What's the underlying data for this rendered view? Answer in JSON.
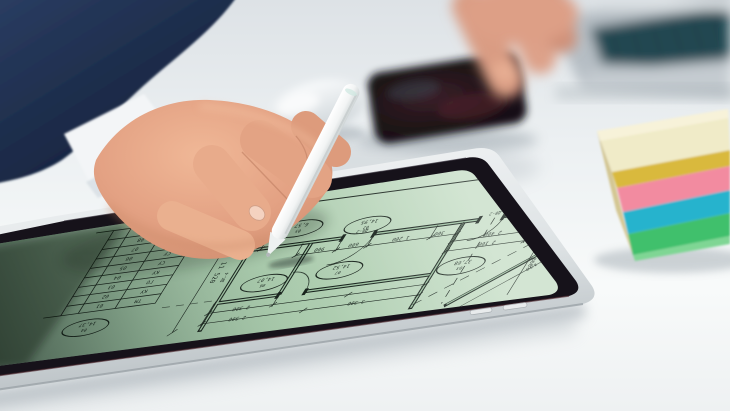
{
  "scene": {
    "description": "Hand in dark suit holding white stylus over tablet displaying architectural floor plan",
    "objects": [
      "suit-sleeve",
      "shirt-cuff",
      "hand",
      "white-stylus",
      "tablet",
      "floor-plan",
      "smartphone",
      "second-hand",
      "laptop-keyboard",
      "computer-mouse",
      "sticky-note-stack",
      "desk"
    ]
  },
  "palette": {
    "screen_green": "#a6c8a9",
    "screen_green_light": "#c8dfc8",
    "screen_green_dark": "#7d9f87",
    "blueprint_line": "#18231c",
    "tablet_bezel": "#16121a",
    "tablet_frame": "#dfe3e5",
    "suit_navy": "#20314f",
    "skin": "#e3a183",
    "stylus_white": "#f7f9f9",
    "sticky_cream": "#f0ebc8",
    "sticky_yellow": "#d9b93e",
    "sticky_pink": "#f28ba0",
    "sticky_cyan": "#28b3cd",
    "sticky_green": "#3fc06c",
    "laptop_keys": "#1f4a54",
    "desk": "#eef1f3"
  },
  "blueprint": {
    "rooms": [
      {
        "id": "05",
        "area": "6,57"
      },
      {
        "id": "02",
        "area": "14,95"
      },
      {
        "id": "06",
        "area": "14,07"
      },
      {
        "id": "07",
        "area": "14,52"
      },
      {
        "id": "04",
        "area": "14,37"
      },
      {
        "id": "03",
        "area": "37,68"
      }
    ],
    "dims": [
      "11 520",
      "900",
      "600",
      "1 200",
      "300",
      "2 400",
      "2 100",
      "2 300",
      "2 500",
      "3 300",
      "1 000",
      "900",
      "1 100",
      "1 800",
      "600",
      "3 130"
    ],
    "doors": [
      "ДВ-2",
      "ДВ-2",
      "ДК-4"
    ],
    "schedule": {
      "rows": [
        {
          "num": "09",
          "code": "КО"
        },
        {
          "num": "08",
          "code": "КО"
        },
        {
          "num": "07",
          "code": "КО"
        },
        {
          "num": "06",
          "code": "СУ"
        },
        {
          "num": "05",
          "code": "СУ"
        },
        {
          "num": "04",
          "code": "КУ"
        },
        {
          "num": "03",
          "code": "ГО"
        },
        {
          "num": "02",
          "code": "КУ"
        },
        {
          "num": "01",
          "code": "ТМ"
        }
      ]
    }
  }
}
